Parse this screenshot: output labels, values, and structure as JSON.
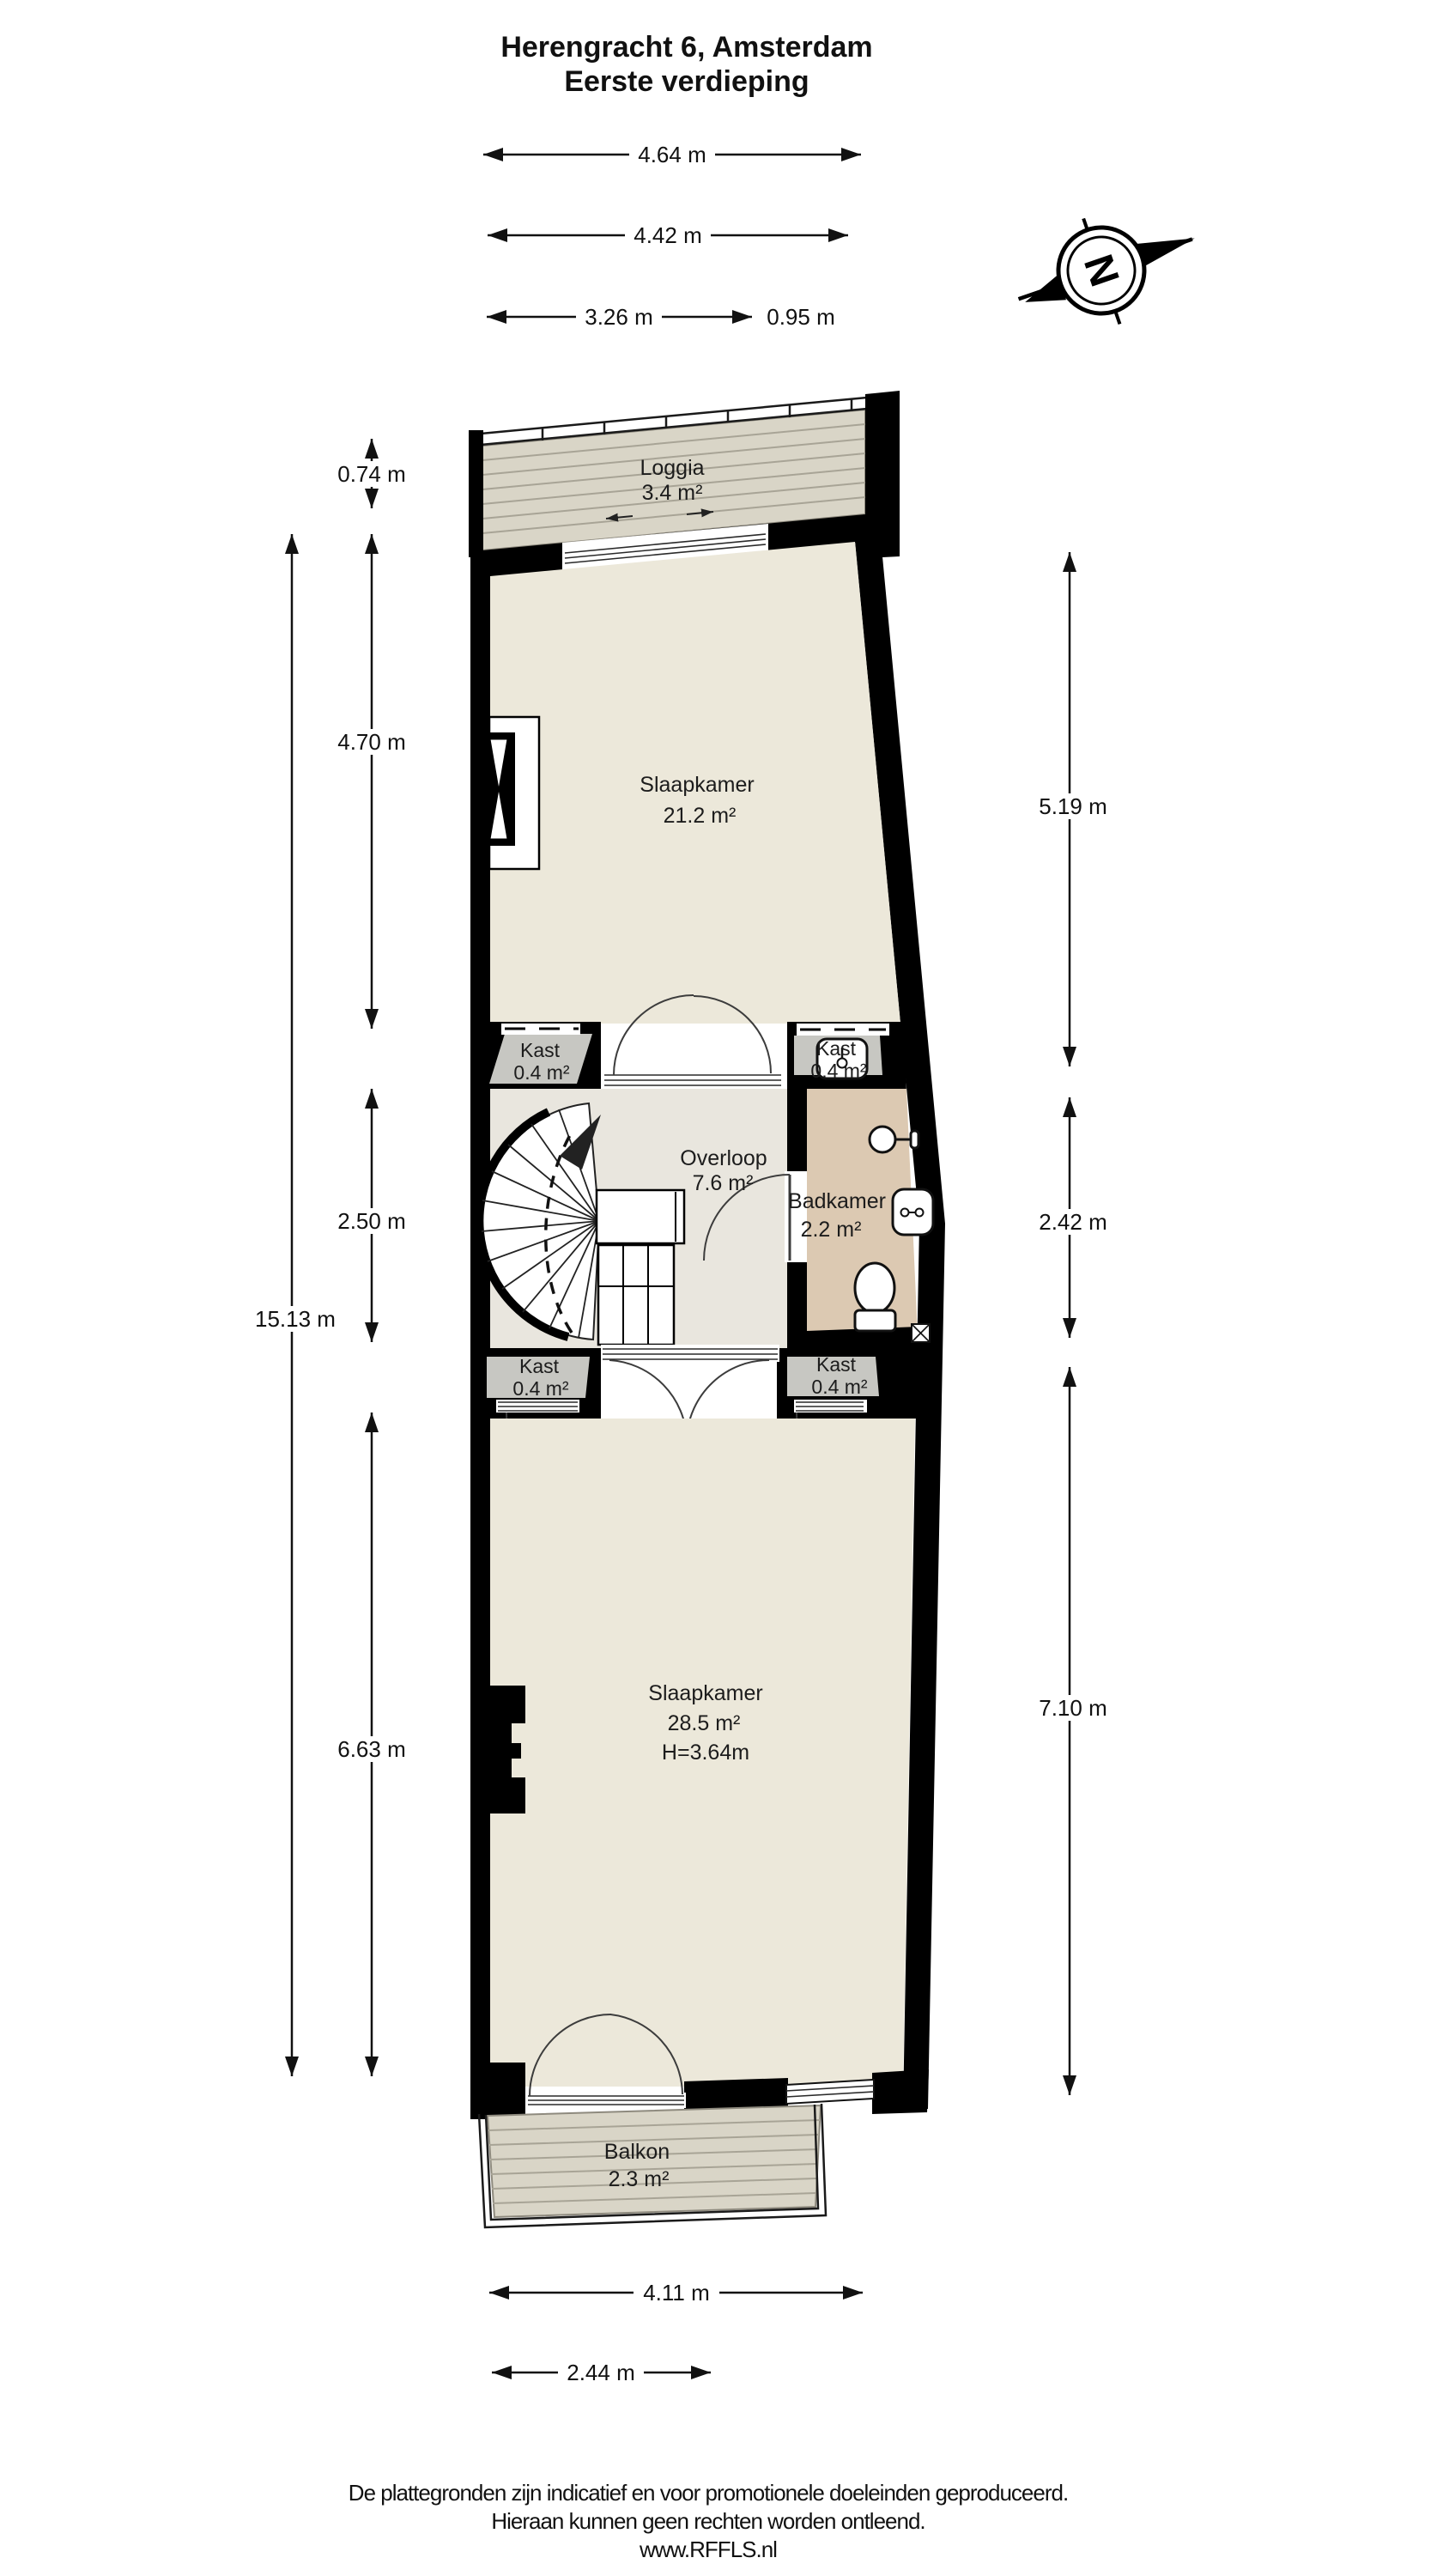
{
  "header": {
    "title": "Herengracht 6, Amsterdam",
    "subtitle": "Eerste verdieping"
  },
  "compass": {
    "label": "N"
  },
  "plan": {
    "rooms": {
      "loggia": {
        "name": "Loggia",
        "area": "3.4 m²"
      },
      "slaapkamer_voor": {
        "name": "Slaapkamer",
        "area": "21.2 m²"
      },
      "kast_boven_links": {
        "name": "Kast",
        "area": "0.4 m²"
      },
      "kast_boven_rechts": {
        "name": "Kast",
        "area": "0.4 m²"
      },
      "overloop": {
        "name": "Overloop",
        "area": "7.6 m²"
      },
      "badkamer": {
        "name": "Badkamer",
        "area": "2.2 m²"
      },
      "kast_onder_links": {
        "name": "Kast",
        "area": "0.4 m²"
      },
      "kast_onder_rechts": {
        "name": "Kast",
        "area": "0.4 m²"
      },
      "slaapkamer_achter": {
        "name": "Slaapkamer",
        "area": "28.5 m²",
        "plafondhoogte": "H=3.64m"
      },
      "balkon": {
        "name": "Balkon",
        "area": "2.3 m²"
      }
    },
    "colors": {
      "wall": "#000000",
      "room": "#ece8da",
      "hal": "#e9e6de",
      "kast": "#c7c7c2",
      "badkamer": "#dcc9b2",
      "deck": "#d9d5c7",
      "deck_line": "#a8a496"
    }
  },
  "dimensions": {
    "top": [
      "4.64 m",
      "4.42 m",
      "3.26 m",
      "0.95 m"
    ],
    "left": [
      "0.74 m",
      "4.70 m",
      "2.50 m",
      "15.13 m",
      "6.63 m"
    ],
    "right": [
      "5.19 m",
      "2.42 m",
      "7.10 m"
    ],
    "bottom": [
      "4.11 m",
      "2.44 m"
    ]
  },
  "footer": {
    "line1": "De plattegronden zijn indicatief en voor promotionele doeleinden geproduceerd.",
    "line2": "Hieraan kunnen geen rechten worden ontleend.",
    "line3": "www.RFFLS.nl"
  }
}
